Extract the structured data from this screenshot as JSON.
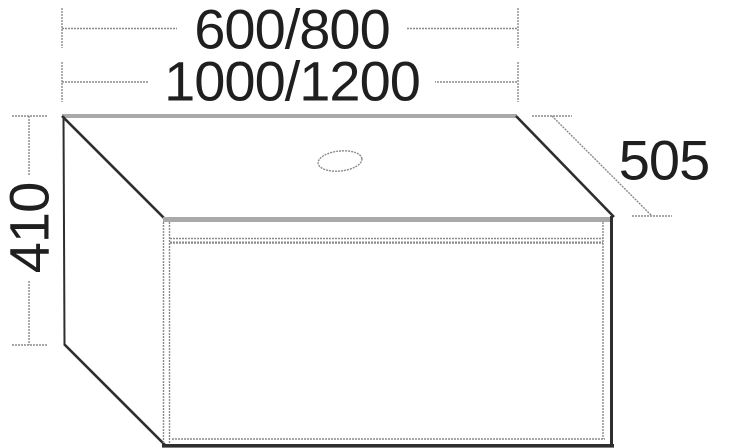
{
  "drawing": {
    "kind": "vanity-unit-dimension-diagram",
    "dimensions": {
      "width_primary": "600/800",
      "width_secondary": "1000/1200",
      "height": "410",
      "depth": "505"
    },
    "colors": {
      "background": "#ffffff",
      "outline_dark": "#2e2e2e",
      "dimension_gray": "#8a8a8a",
      "panel_band_gray": "#a9a9a9",
      "text": "#1f1f1f"
    }
  }
}
